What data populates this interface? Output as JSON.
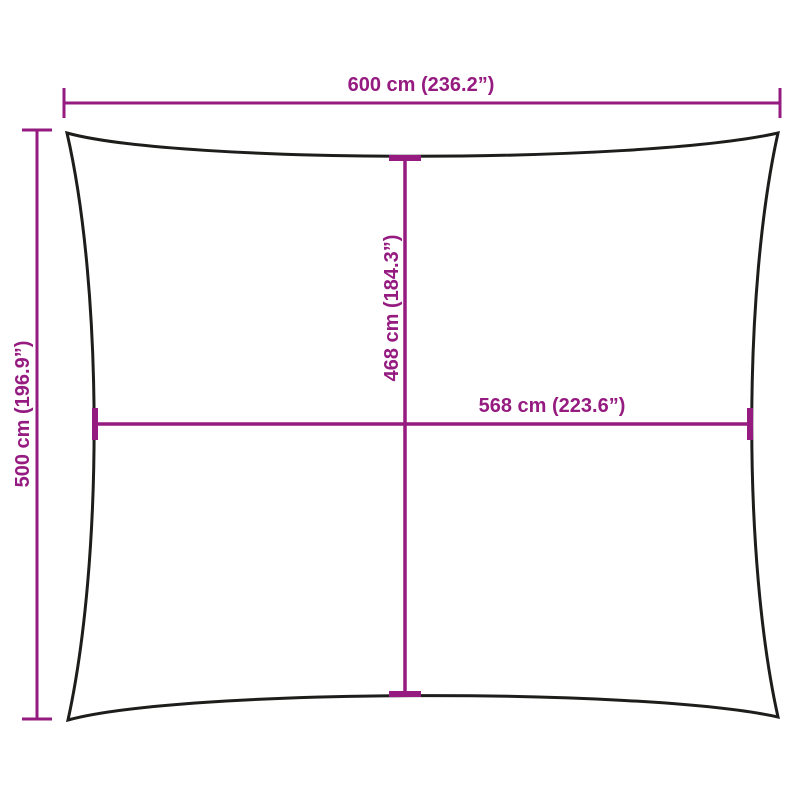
{
  "colors": {
    "dimension_accent": "#951B81",
    "sail_outline": "#1D1D1B",
    "background": "#FFFFFF"
  },
  "diagram": {
    "shape": "rectangular-shade-sail-concave-edges",
    "labels": {
      "top_width": "600 cm (236.2”)",
      "side_height": "500 cm (196.9”)",
      "inner_height": "468 cm (184.3”)",
      "inner_width": "568 cm (223.6”)"
    }
  }
}
